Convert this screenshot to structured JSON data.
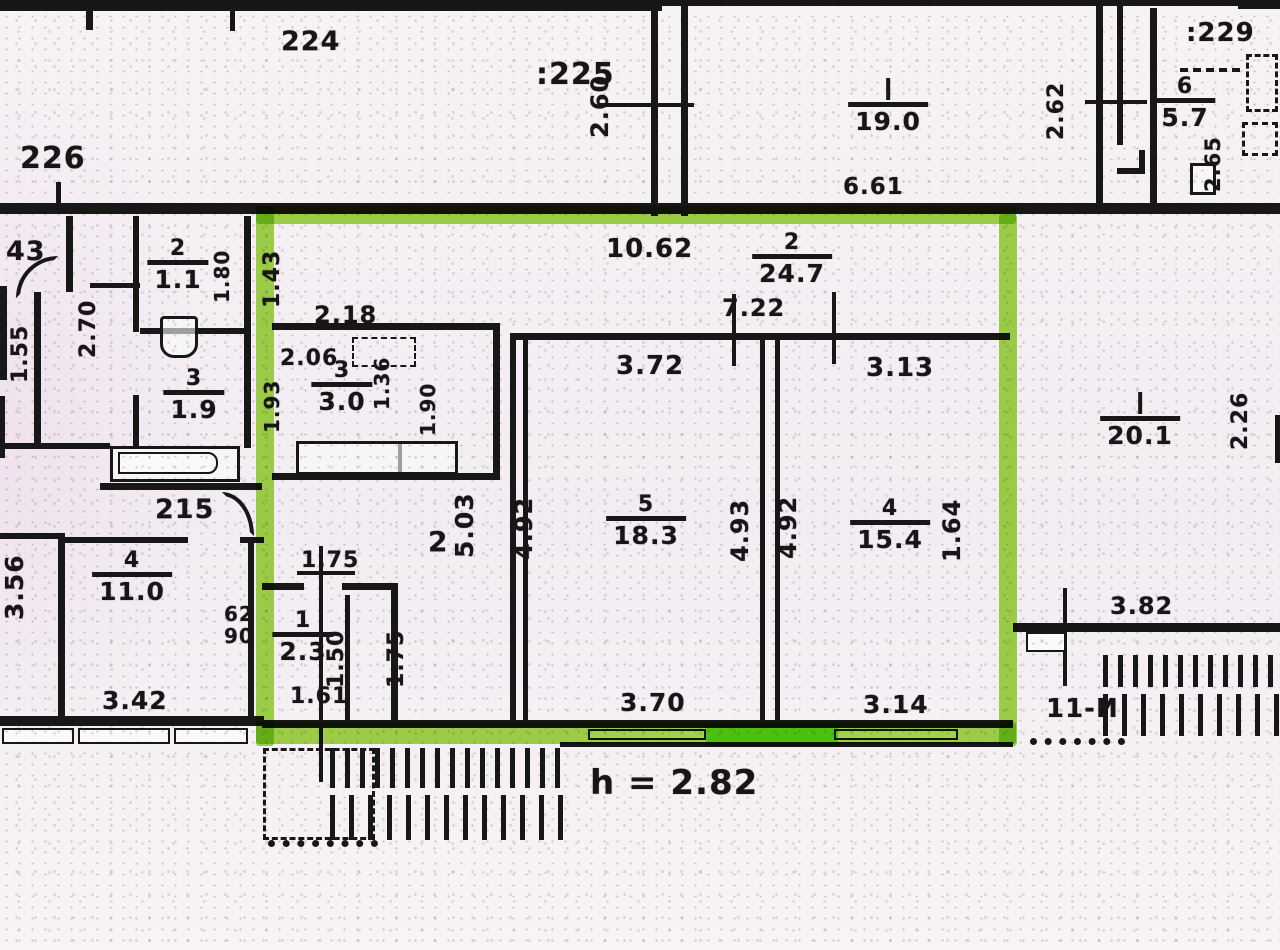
{
  "document": {
    "kind": "scanned apartment floor plan (BTI)",
    "height_note": "h = 2.82",
    "colors": {
      "highlight_green": "#8cd332",
      "highlight_bright": "#77ef25",
      "ink": "#171717",
      "paper": "#f5f1f4"
    }
  },
  "unit_labels": [
    {
      "text": "224",
      "x": 281,
      "y": 28,
      "fs": 27
    },
    {
      "text": ":225",
      "x": 536,
      "y": 60,
      "fs": 30
    },
    {
      "text": "226",
      "x": 20,
      "y": 144,
      "fs": 30
    },
    {
      "text": ":229",
      "x": 1186,
      "y": 20,
      "fs": 26
    },
    {
      "text": "43",
      "x": 6,
      "y": 238,
      "fs": 27
    },
    {
      "text": "215",
      "x": 155,
      "y": 496,
      "fs": 27
    },
    {
      "text": "11-И",
      "x": 1046,
      "y": 696,
      "fs": 26
    },
    {
      "text": "2",
      "x": 428,
      "y": 528,
      "fs": 28
    }
  ],
  "rooms": [
    {
      "num": "2",
      "area": "24.7",
      "cx": 792,
      "cy": 232
    },
    {
      "num": "5",
      "area": "18.3",
      "cx": 646,
      "cy": 494
    },
    {
      "num": "4",
      "area": "15.4",
      "cx": 890,
      "cy": 498
    },
    {
      "num": "1",
      "area": "2.3",
      "cx": 303,
      "cy": 610
    },
    {
      "num": "",
      "area": "19.0",
      "cx": 888,
      "cy": 78,
      "tick": true
    },
    {
      "num": "6",
      "area": "5.7",
      "cx": 1185,
      "cy": 76
    },
    {
      "num": "",
      "area": "20.1",
      "cx": 1140,
      "cy": 392,
      "tick": true
    },
    {
      "num": "2",
      "area": "1.1",
      "cx": 178,
      "cy": 238
    },
    {
      "num": "3",
      "area": "1.9",
      "cx": 194,
      "cy": 368
    },
    {
      "num": "4",
      "area": "11.0",
      "cx": 132,
      "cy": 550
    },
    {
      "num": "3",
      "area": "3.0",
      "cx": 342,
      "cy": 360
    }
  ],
  "dims_h": [
    {
      "text": "10.62",
      "x": 606,
      "y": 236,
      "fs": 26
    },
    {
      "text": "7.22",
      "x": 722,
      "y": 296,
      "fs": 24
    },
    {
      "text": "3.72",
      "x": 616,
      "y": 353,
      "fs": 26
    },
    {
      "text": "3.13",
      "x": 866,
      "y": 355,
      "fs": 26
    },
    {
      "text": "2.18",
      "x": 314,
      "y": 303,
      "fs": 24
    },
    {
      "text": "2.06",
      "x": 280,
      "y": 348,
      "fs": 22
    },
    {
      "text": "6.61",
      "x": 843,
      "y": 176,
      "fs": 23
    },
    {
      "text": "3.42",
      "x": 102,
      "y": 688,
      "fs": 25
    },
    {
      "text": "62",
      "x": 224,
      "y": 604,
      "fs": 20
    },
    {
      "text": "90",
      "x": 224,
      "y": 626,
      "fs": 20
    },
    {
      "text": "1.75",
      "x": 301,
      "y": 550,
      "fs": 22
    },
    {
      "text": "1.61",
      "x": 290,
      "y": 686,
      "fs": 22
    },
    {
      "text": "3.70",
      "x": 620,
      "y": 690,
      "fs": 25
    },
    {
      "text": "3.14",
      "x": 863,
      "y": 692,
      "fs": 25
    },
    {
      "text": "3.82",
      "x": 1110,
      "y": 594,
      "fs": 24
    }
  ],
  "dims_v": [
    {
      "text": "2.60",
      "x": 612,
      "y": 138,
      "fs": 24
    },
    {
      "text": "2.62",
      "x": 1068,
      "y": 140,
      "fs": 22
    },
    {
      "text": "2.65",
      "x": 1224,
      "y": 192,
      "fs": 21
    },
    {
      "text": "1.43",
      "x": 284,
      "y": 308,
      "fs": 22
    },
    {
      "text": "2.70",
      "x": 100,
      "y": 358,
      "fs": 22
    },
    {
      "text": "1.55",
      "x": 32,
      "y": 383,
      "fs": 22
    },
    {
      "text": "1.80",
      "x": 232,
      "y": 303,
      "fs": 20
    },
    {
      "text": "1.36",
      "x": 392,
      "y": 410,
      "fs": 20
    },
    {
      "text": "1.90",
      "x": 438,
      "y": 436,
      "fs": 20
    },
    {
      "text": "1.93",
      "x": 282,
      "y": 433,
      "fs": 20
    },
    {
      "text": "5.03",
      "x": 477,
      "y": 558,
      "fs": 25
    },
    {
      "text": "4.92",
      "x": 536,
      "y": 560,
      "fs": 24
    },
    {
      "text": "4.93",
      "x": 752,
      "y": 562,
      "fs": 24
    },
    {
      "text": "4.92",
      "x": 800,
      "y": 559,
      "fs": 24
    },
    {
      "text": "1.64",
      "x": 964,
      "y": 562,
      "fs": 24
    },
    {
      "text": "2.26",
      "x": 1252,
      "y": 450,
      "fs": 22
    },
    {
      "text": "3.56",
      "x": 27,
      "y": 620,
      "fs": 25
    },
    {
      "text": "1.50",
      "x": 348,
      "y": 688,
      "fs": 22
    },
    {
      "text": "1.75",
      "x": 408,
      "y": 688,
      "fs": 22
    }
  ],
  "notes": [
    {
      "text": "h = 2.82",
      "x": 590,
      "y": 766,
      "fs": 34
    }
  ]
}
